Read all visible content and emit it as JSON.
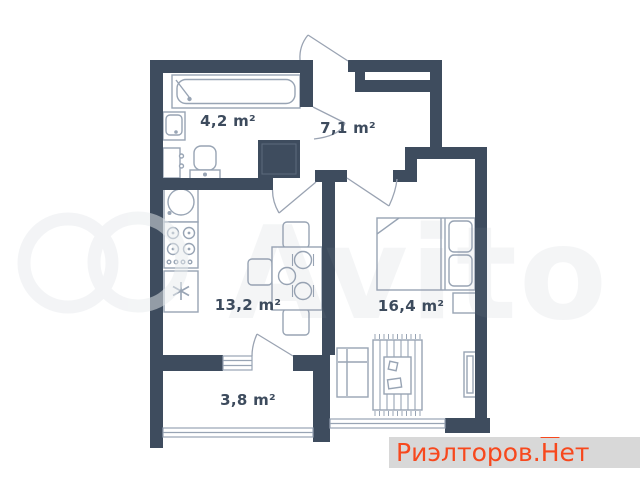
{
  "title": "apartment-floor-plan",
  "rooms": {
    "bathroom": {
      "name": "bathroom",
      "area_label": "4,2 m²"
    },
    "hallway": {
      "name": "hallway",
      "area_label": "7,1 m²"
    },
    "kitchen": {
      "name": "kitchen-living",
      "area_label": "13,2 m²"
    },
    "bedroom": {
      "name": "bedroom",
      "area_label": "16,4 m²"
    },
    "balcony": {
      "name": "balcony",
      "area_label": "3,8 m²"
    }
  },
  "watermark": {
    "brand": "Avito"
  },
  "branding": {
    "prefix": "Риэлторов.",
    "roof_letter": "Н",
    "suffix": "ет"
  },
  "colors": {
    "wall": "#3e4c5e",
    "fixture_line": "#98a4b4",
    "label_text": "#3d4b5d",
    "brand_text": "#f7481d",
    "brand_background": "#d8d8d8"
  }
}
